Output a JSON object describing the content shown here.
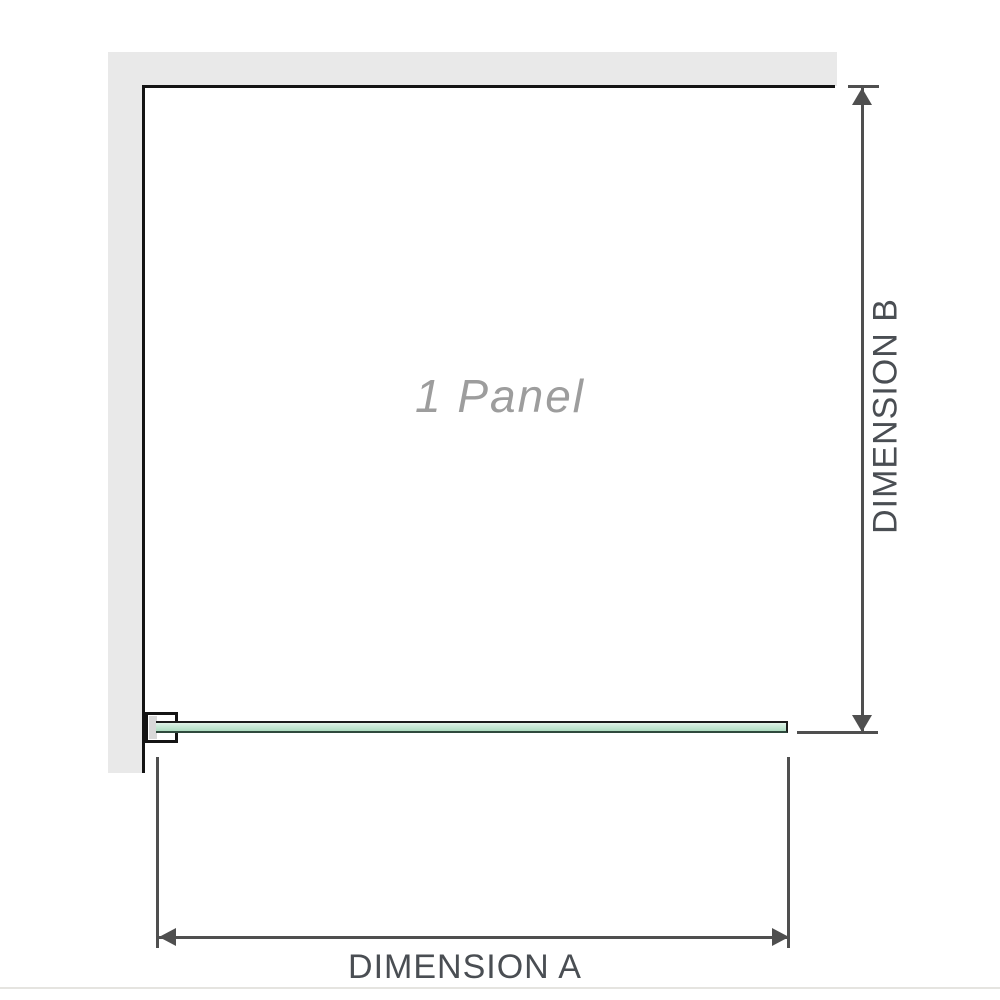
{
  "diagram": {
    "panel_label": "1 Panel",
    "dimension_a_label": "DIMENSION A",
    "dimension_b_label": "DIMENSION B"
  },
  "colors": {
    "background": "#ffffff",
    "wall": "#e9e9e9",
    "wall_edge": "#141414",
    "glass_fill": "#aedcc1",
    "glass_border": "#1c1c1c",
    "dimension_line": "#4f4f4f",
    "label_text": "#4a4e53",
    "panel_label_text": "#9d9d9d",
    "bottom_divider": "#e5e4e0"
  }
}
